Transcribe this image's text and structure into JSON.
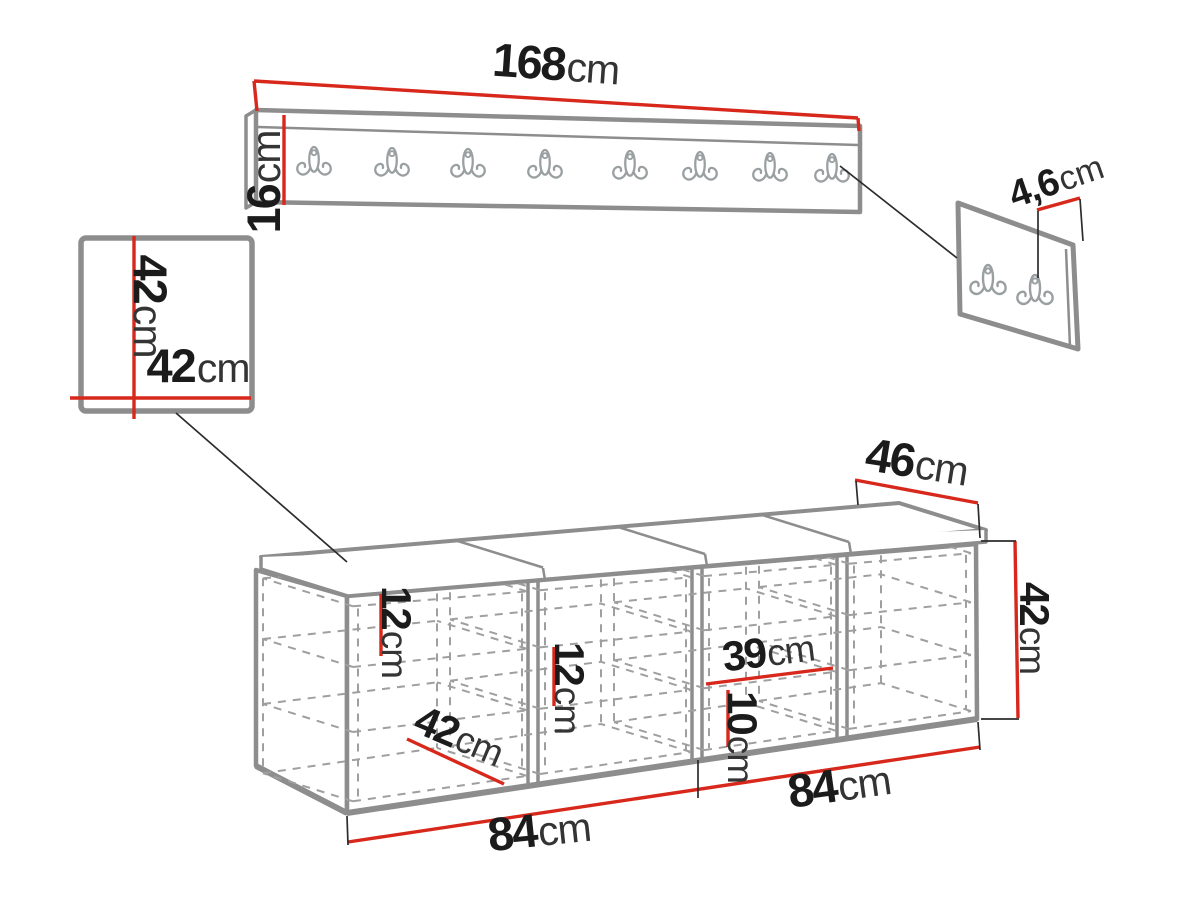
{
  "diagram": {
    "type": "furniture-dimension-drawing",
    "pieces": {
      "coat_rack": {
        "name": "wall coat rack",
        "hook_count": 8
      },
      "mirror_panel": {
        "name": "square wall panel"
      },
      "hook_panel": {
        "name": "small hook panel",
        "hook_count": 2
      },
      "shoe_bench": {
        "name": "shoe bench with cushion",
        "compartments": 4
      }
    },
    "colors": {
      "dimension_red": "#d7281b",
      "furniture_gray": "#8d8d8d",
      "dash_gray": "#9f9f9f",
      "hook_gray": "#9aa0a2",
      "text_black": "#1b1b1b",
      "background": "#ffffff"
    }
  },
  "dims": {
    "rack_width": {
      "v": "168",
      "u": "cm"
    },
    "rack_height": {
      "v": "16",
      "u": "cm"
    },
    "mirror_height": {
      "v": "42",
      "u": "cm"
    },
    "mirror_width": {
      "v": "42",
      "u": "cm"
    },
    "hook_panel_depth": {
      "v": "4,6",
      "u": "cm"
    },
    "bench_depth": {
      "v": "46",
      "u": "cm"
    },
    "bench_height": {
      "v": "42",
      "u": "cm"
    },
    "shelf_gap_1": {
      "v": "12",
      "u": "cm"
    },
    "shelf_gap_2": {
      "v": "12",
      "u": "cm"
    },
    "compartment_width": {
      "v": "39",
      "u": "cm"
    },
    "bottom_gap": {
      "v": "10",
      "u": "cm"
    },
    "inner_depth": {
      "v": "42",
      "u": "cm"
    },
    "half_width_left": {
      "v": "84",
      "u": "cm"
    },
    "half_width_right": {
      "v": "84",
      "u": "cm"
    }
  }
}
